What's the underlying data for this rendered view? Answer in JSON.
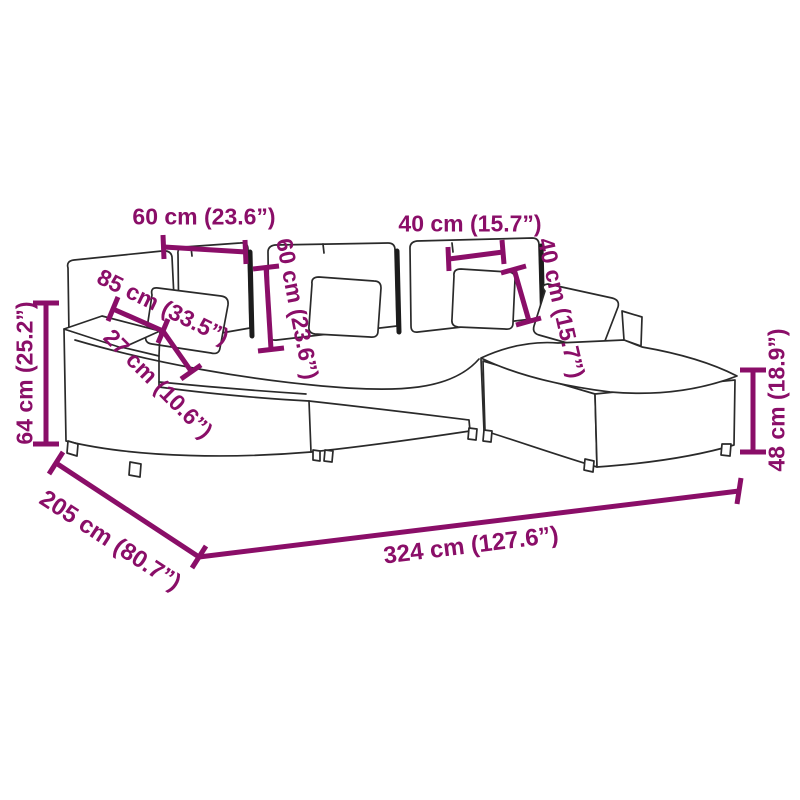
{
  "diagram_type": "sofa-dimension-diagram",
  "colors": {
    "dimension_annotation": "#8a0e68",
    "line_art": "#2a2a2a",
    "background": "#ffffff"
  },
  "labels": {
    "back_cushion_width": "60 cm (23.6”)",
    "back_cushion_height": "60 cm (23.6”)",
    "pillow_width": "40 cm (15.7”)",
    "pillow_height": "40 cm (15.7”)",
    "seat_depth": "85 cm (33.5”)",
    "armrest_width": "27 cm (10.6”)",
    "seat_height": "64 cm (25.2”)",
    "ottoman_height": "48 cm (18.9”)",
    "total_depth": "205 cm (80.7”)",
    "total_width": "324 cm (127.6”)"
  }
}
